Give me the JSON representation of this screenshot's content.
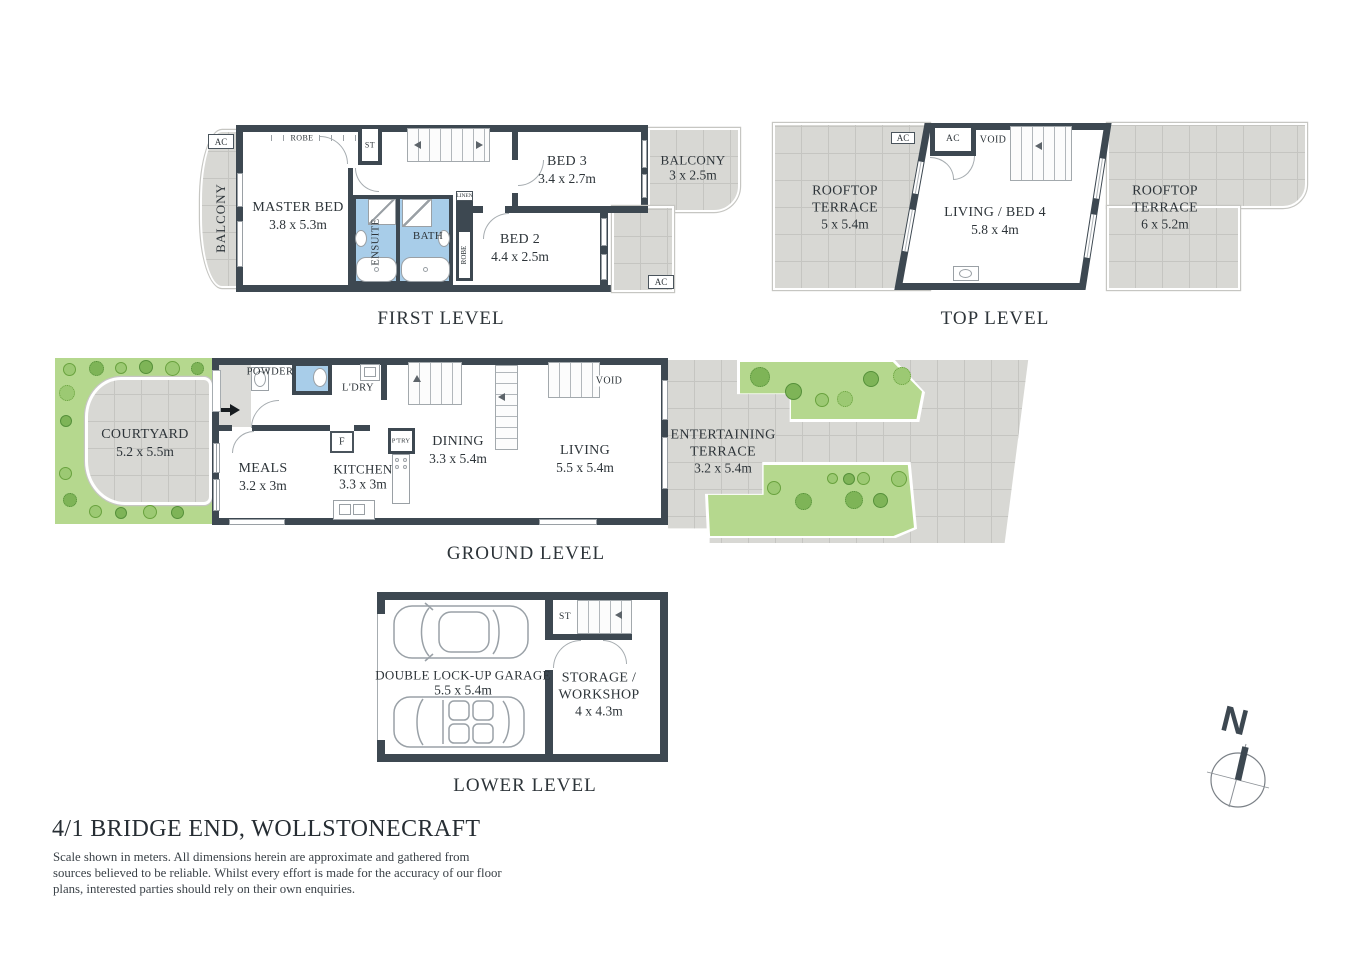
{
  "palette": {
    "wall": "#3d4851",
    "paving": "#d8d8d4",
    "garden": "#b5d88e",
    "wet_area": "#a8cde9",
    "text": "#2d3439"
  },
  "compass": {
    "north_label": "N"
  },
  "footer": {
    "title": "4/1 BRIDGE END, WOLLSTONECRAFT",
    "disclaimer_lines": [
      "Scale shown in meters. All dimensions herein are approximate and gathered from",
      "sources believed to be  reliable. Whilst every effort is made for the accuracy of our floor",
      "plans, interested parties should rely on their own enquiries."
    ]
  },
  "levels": {
    "first": {
      "caption": "FIRST LEVEL",
      "balcony_left": "BALCONY",
      "ac_top": "AC",
      "ac_bottom": "AC",
      "robe_top": "ROBE",
      "store": "ST",
      "master_name": "MASTER BED",
      "master_dims": "3.8 x 5.3m",
      "ensuite": "ENSUITE",
      "bath": "BATH",
      "linen": "LINEN",
      "robe_side": "ROBE",
      "bed3_name": "BED 3",
      "bed3_dims": "3.4 x 2.7m",
      "bed2_name": "BED 2",
      "bed2_dims": "4.4 x 2.5m",
      "balcony_right_name": "BALCONY",
      "balcony_right_dims": "3 x 2.5m"
    },
    "top": {
      "caption": "TOP LEVEL",
      "terrace_left_name": "ROOFTOP TERRACE",
      "terrace_left_dims": "5 x 5.4m",
      "ac_wall": "AC",
      "ac_unit": "AC",
      "void": "VOID",
      "living_name": "LIVING / BED 4",
      "living_dims": "5.8 x 4m",
      "terrace_right_name": "ROOFTOP TERRACE",
      "terrace_right_dims": "6 x 5.2m"
    },
    "ground": {
      "caption": "GROUND LEVEL",
      "courtyard_name": "COURTYARD",
      "courtyard_dims": "5.2 x 5.5m",
      "powder": "POWDER",
      "laundry": "L'DRY",
      "fridge": "F",
      "pantry": "P'TRY",
      "void": "VOID",
      "meals_name": "MEALS",
      "meals_dims": "3.2 x 3m",
      "kitchen_name": "KITCHEN",
      "kitchen_dims": "3.3 x 3m",
      "dining_name": "DINING",
      "dining_dims": "3.3 x 5.4m",
      "living_name": "LIVING",
      "living_dims": "5.5 x 5.4m",
      "terrace_name": "ENTERTAINING TERRACE",
      "terrace_dims": "3.2 x 5.4m"
    },
    "lower": {
      "caption": "LOWER LEVEL",
      "store": "ST",
      "garage_name": "DOUBLE LOCK-UP GARAGE",
      "garage_dims": "5.5 x 5.4m",
      "storage_name": "STORAGE / WORKSHOP",
      "storage_dims": "4 x 4.3m"
    }
  }
}
